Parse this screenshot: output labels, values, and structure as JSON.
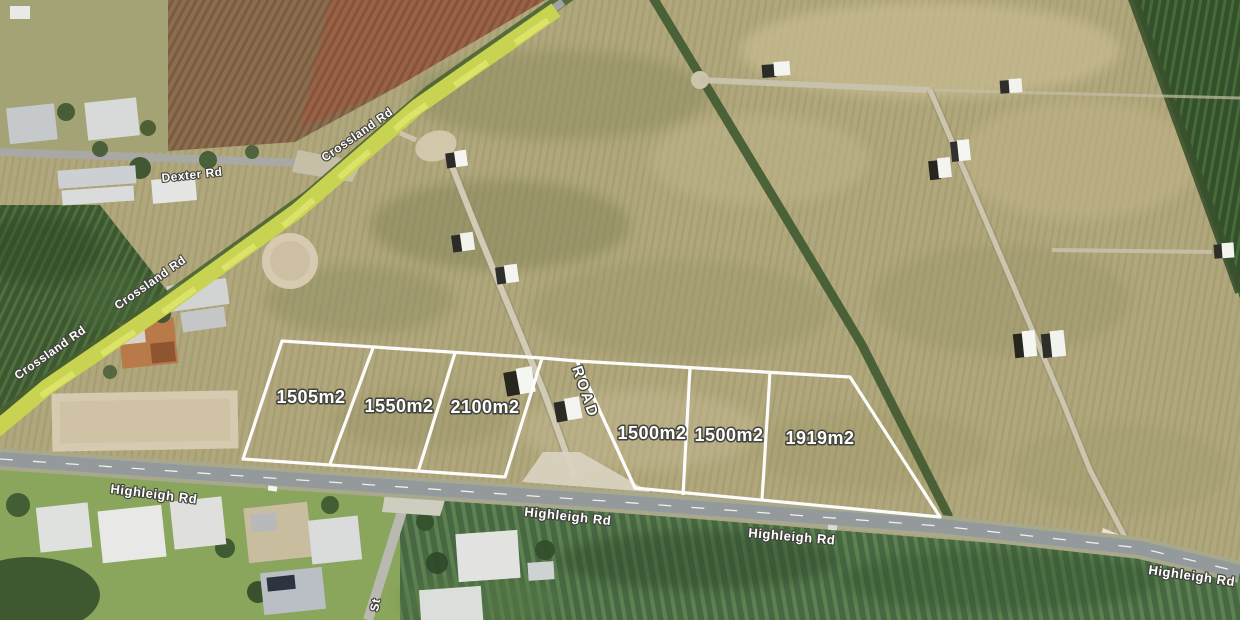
{
  "map": {
    "type": "aerial-subdivision-plan",
    "road_labels": {
      "crossland_rd": "Crossland Rd",
      "dexter_rd": "Dexter Rd",
      "highleigh_rd": "Highleigh Rd",
      "new_internal_road": "ROAD",
      "side_street_partial": "St"
    },
    "lots": [
      {
        "area_label": "1505m2"
      },
      {
        "area_label": "1550m2"
      },
      {
        "area_label": "2100m2"
      },
      {
        "area_label": "1500m2"
      },
      {
        "area_label": "1500m2"
      },
      {
        "area_label": "1919m2"
      }
    ],
    "colors": {
      "lot_boundary": "#ffffff",
      "label_fill": "#ffffff",
      "label_outline": "#42423d",
      "paddock": "#b1a77c",
      "cane_field": "#3d5731",
      "road_verge": "#ccd84f",
      "asphalt": "#94999b"
    }
  }
}
